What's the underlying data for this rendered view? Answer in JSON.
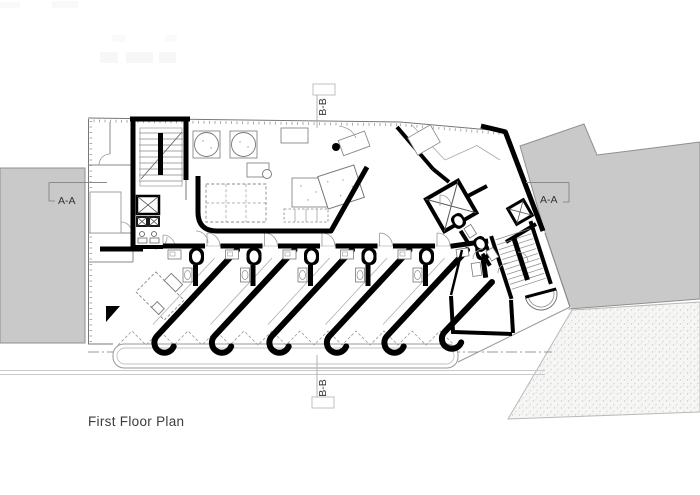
{
  "drawing": {
    "title": "First Floor Plan",
    "markers": {
      "left": "A-A",
      "right": "A-A",
      "top": "B-B",
      "bottom": "B-B"
    }
  },
  "colors": {
    "wall": "#000000",
    "site_mass": "#c9c9c9",
    "thin_line": "#888888",
    "ground_line": "#c9c9c9",
    "text": "#3a3a3a",
    "background": "#ffffff"
  }
}
